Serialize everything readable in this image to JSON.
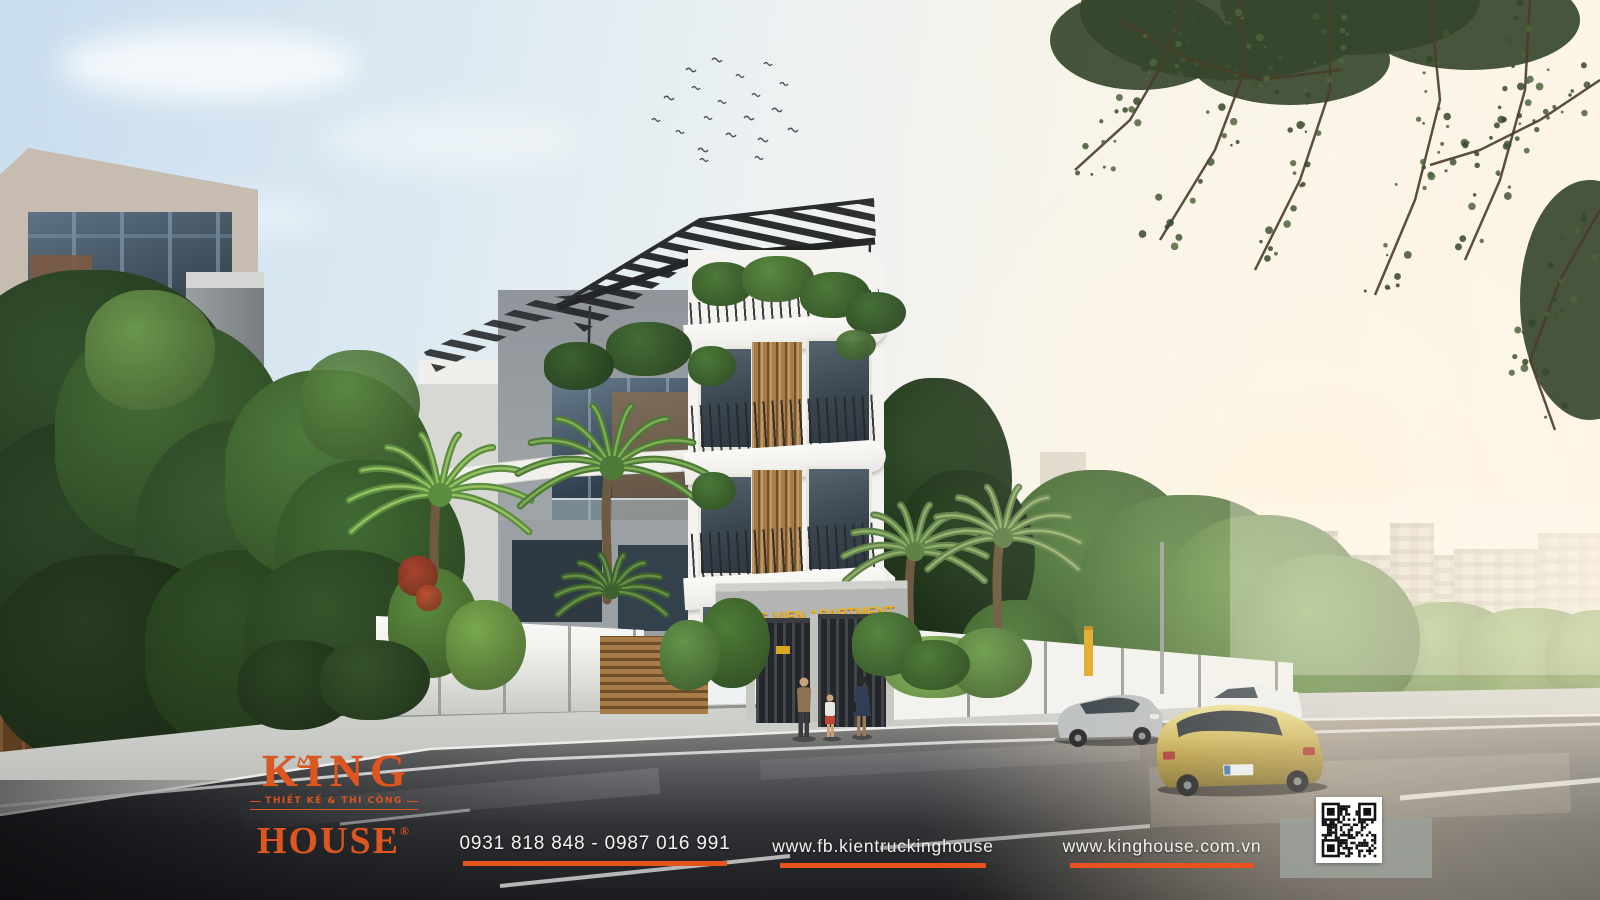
{
  "scene": {
    "type": "architectural-exterior-rendering",
    "building_sign": "HUNG VIEN APARTMENT",
    "sign_color": "#F2B31E"
  },
  "branding": {
    "accent_color": "#E8521C",
    "logo": {
      "name": "KING",
      "tagline": "THIẾT KẾ & THI CÔNG",
      "name2": "HOUSE",
      "registered": "®"
    },
    "contact": {
      "phone": "0931 818 848 - 0987 016 991",
      "facebook": "www.fb.kientruckinghouse",
      "website": "www.kinghouse.com.vn"
    }
  }
}
